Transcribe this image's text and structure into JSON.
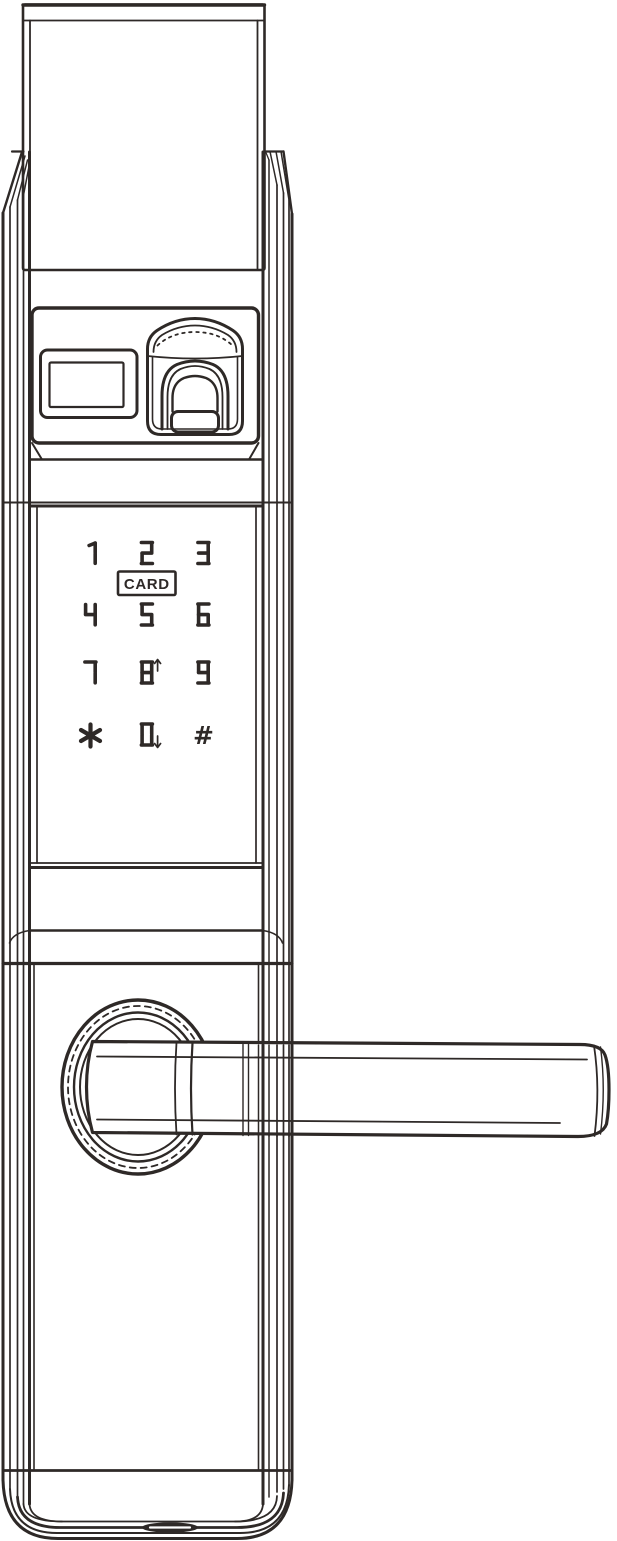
{
  "figure": {
    "subject": "Smart door lock with fingerprint scanner, keypad and lever handle - front view line drawing",
    "style": "monochrome outline drawing"
  },
  "colors": {
    "line": "#2e2927",
    "background": "#ffffff"
  },
  "keypad": {
    "card_label": "CARD",
    "rows": [
      [
        {
          "label": "1"
        },
        {
          "label": "2"
        },
        {
          "label": "3"
        }
      ],
      [
        {
          "label": "4"
        },
        {
          "label": "5"
        },
        {
          "label": "6"
        }
      ],
      [
        {
          "label": "7"
        },
        {
          "label": "8",
          "arrow": "up"
        },
        {
          "label": "9"
        }
      ],
      [
        {
          "label": "*"
        },
        {
          "label": "0",
          "arrow": "down"
        },
        {
          "label": "#"
        }
      ]
    ]
  },
  "parts": [
    "top-cover",
    "body-shell",
    "sensor-panel",
    "display-window",
    "fingerprint-scanner",
    "keypad",
    "card-label",
    "handle-rosette",
    "lever-handle",
    "bottom-port"
  ]
}
